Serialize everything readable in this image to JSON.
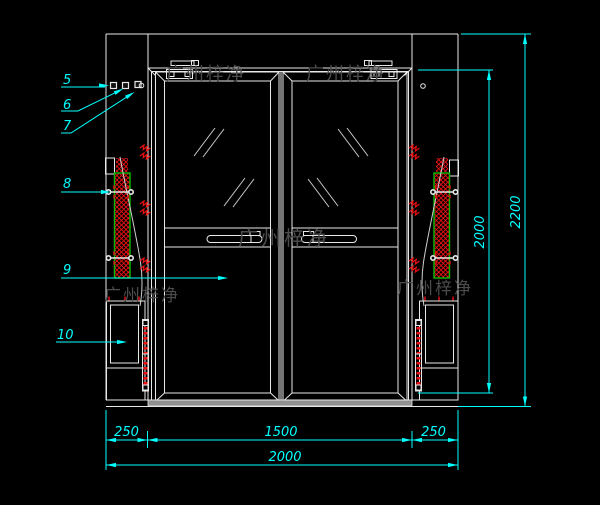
{
  "watermark": {
    "text": "广州梓净"
  },
  "callouts": {
    "c5": "5",
    "c6": "6",
    "c7": "7",
    "c8": "8",
    "c9": "9",
    "c10": "10"
  },
  "dimensions": {
    "bottom_left": "250",
    "door_width": "1500",
    "bottom_right": "250",
    "total_width": "2000",
    "door_height": "2000",
    "total_height": "2200"
  },
  "colors": {
    "background": "#000000",
    "line": "#e8e8e8",
    "dimension": "#00ffff",
    "hatch": "#ee1111",
    "hatch_border": "#00bb00",
    "watermark": "#4c4c4c",
    "threshold": "#909090"
  }
}
